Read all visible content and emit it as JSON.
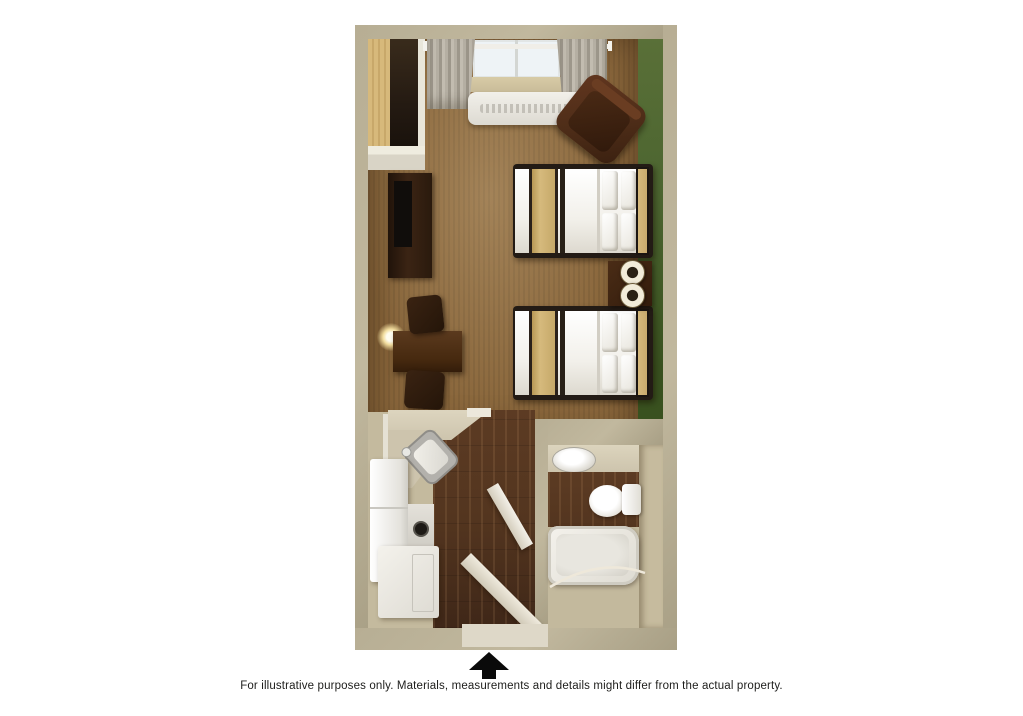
{
  "caption": {
    "text": "For illustrative purposes only.  Materials, measurements and details might differ from the actual property."
  },
  "entrance": {
    "icon": "up-arrow",
    "position": "bottom-center"
  },
  "floor_plan": {
    "description": "3D top-down rendering of a studio suite with two double beds",
    "rooms": [
      {
        "name": "main-room",
        "features": [
          "window",
          "curtains",
          "wall-ac-unit",
          "armchair",
          "closet",
          "dresser-with-tv",
          "desk",
          "desk-lamp",
          "two-desk-chairs",
          "bed-1",
          "bed-2",
          "nightstand",
          "two-table-lamps",
          "green-accent-wall",
          "carpet-floor"
        ]
      },
      {
        "name": "kitchenette",
        "features": [
          "l-shaped-counter",
          "corner-sink",
          "refrigerator",
          "cooktop-burner",
          "lower-cabinet",
          "wood-floor"
        ]
      },
      {
        "name": "bathroom",
        "features": [
          "vanity-counter",
          "oval-sink",
          "toilet",
          "bathtub",
          "shower-curtain-rod",
          "wood-floor",
          "open-door"
        ]
      }
    ],
    "doors": [
      "entry-door-open",
      "bathroom-door-open"
    ]
  },
  "colors": {
    "wall": "#b7ae94",
    "carpet": "#8a673c",
    "green": "#4c6530",
    "wood": "#53351f",
    "bath-floor": "#c3b99d",
    "counter": "#cdc4ad",
    "fixture": "#eceae3",
    "dark-furn": "#352114",
    "chair": "#4e2d18",
    "bed-white": "#f2f0ea",
    "runner": "#d6ba7d",
    "headboard": "#c9ab6e",
    "window": "#eef3f6",
    "curtain": "#aaa499",
    "threshold": "#ded8c8",
    "text": "#1d1d1b",
    "arrow": "#0a0a0a"
  }
}
